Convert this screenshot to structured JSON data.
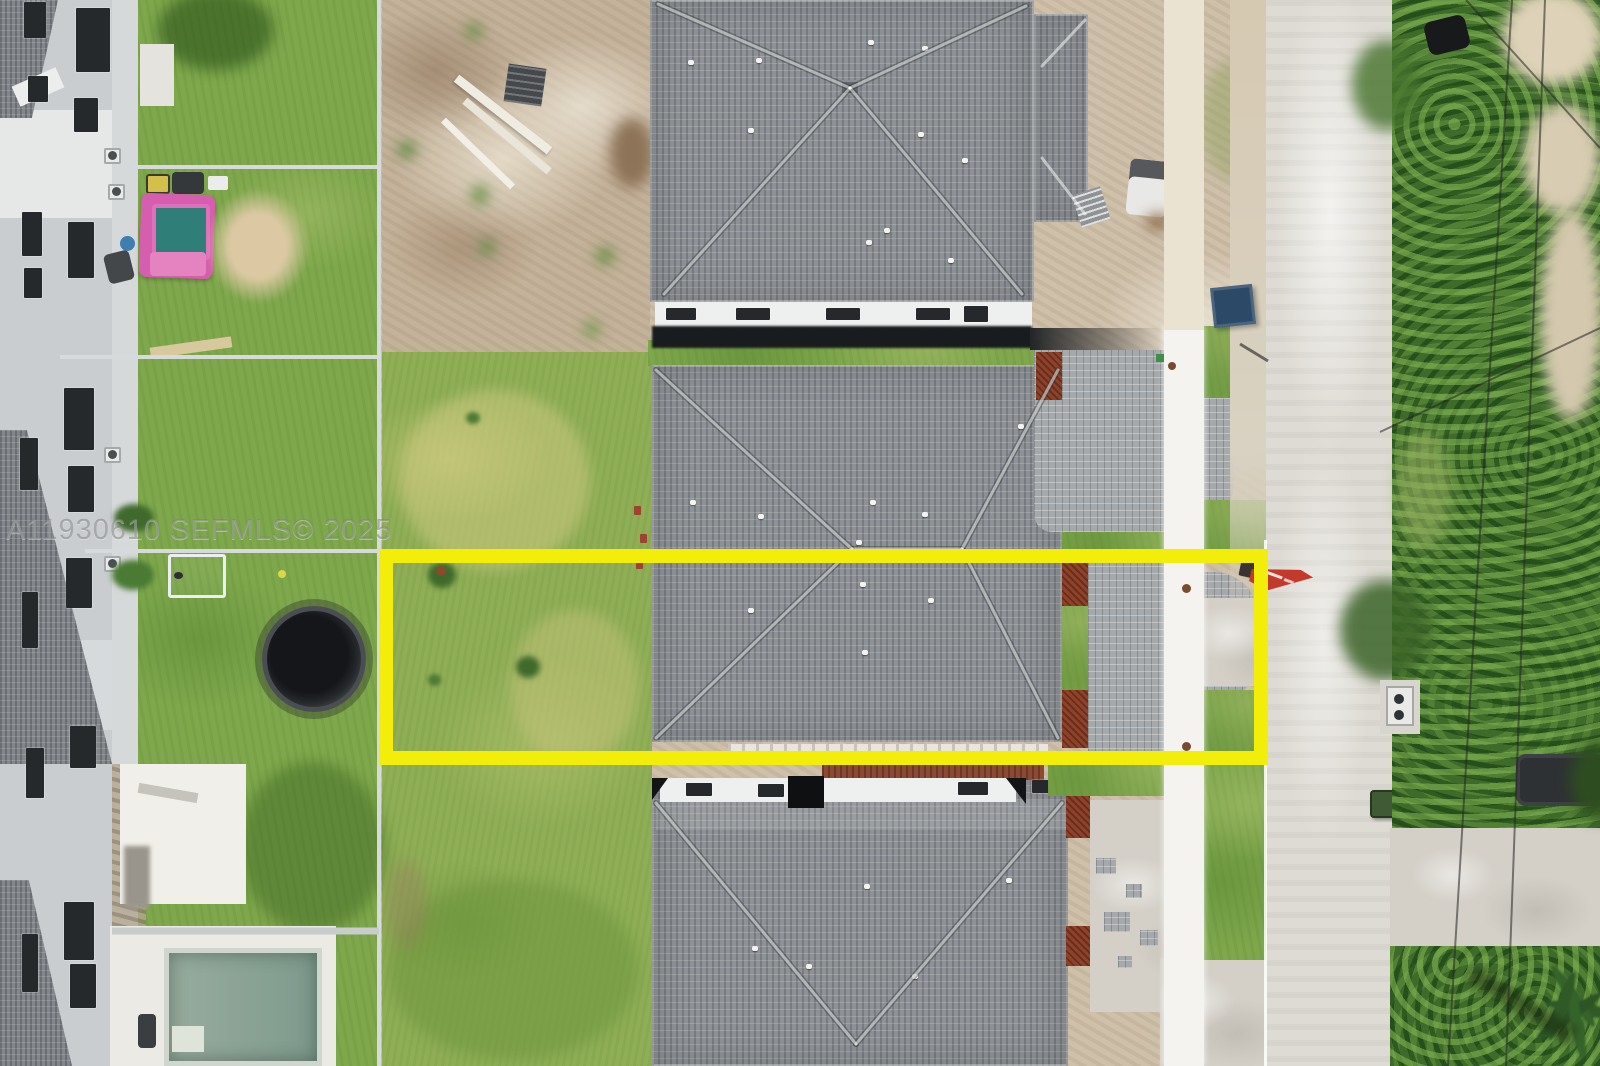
{
  "meta": {
    "kind": "aerial-drone-photo-top-down",
    "subject": "new-construction home lot outlined in yellow on a residential street",
    "watermark_text": "A11930610 SEFMLS© 2025"
  },
  "watermark": {
    "text": "A11930610 SEFMLS© 2025"
  },
  "annotation": {
    "shape": "rectangle",
    "purpose": "property-lot-outline",
    "color": "#f2ee0a"
  },
  "palette": {
    "roof_shingle": "#8e9296",
    "grass": "#8fae56",
    "dirt": "#cfc0aa",
    "road": "#dedbd4",
    "sidewalk": "#f4f3ef",
    "tree_canopy": "#3e6a2a",
    "mulch": "#8d4229",
    "sales_flag": "#c23a2b",
    "pool_water": "#8ea698",
    "playhouse_pink": "#d55fae",
    "dumpster_blue": "#2c4a68"
  },
  "scene_objects": [
    "townhouse-row",
    "backyards",
    "trampoline",
    "kids-playhouse",
    "sand-patch",
    "swimming-pool-under-construction",
    "construction-dirt-lot",
    "lumber-debris",
    "three-new-home-roofs",
    "paver-driveways",
    "sidewalk",
    "street",
    "tree-line",
    "power-lines",
    "red-sales-flag",
    "blue-dumpster",
    "utility-box",
    "white-pickup-truck",
    "parked-suv",
    "green-trash-bin",
    "palm-tree",
    "soccer-goal",
    "ac-units"
  ]
}
